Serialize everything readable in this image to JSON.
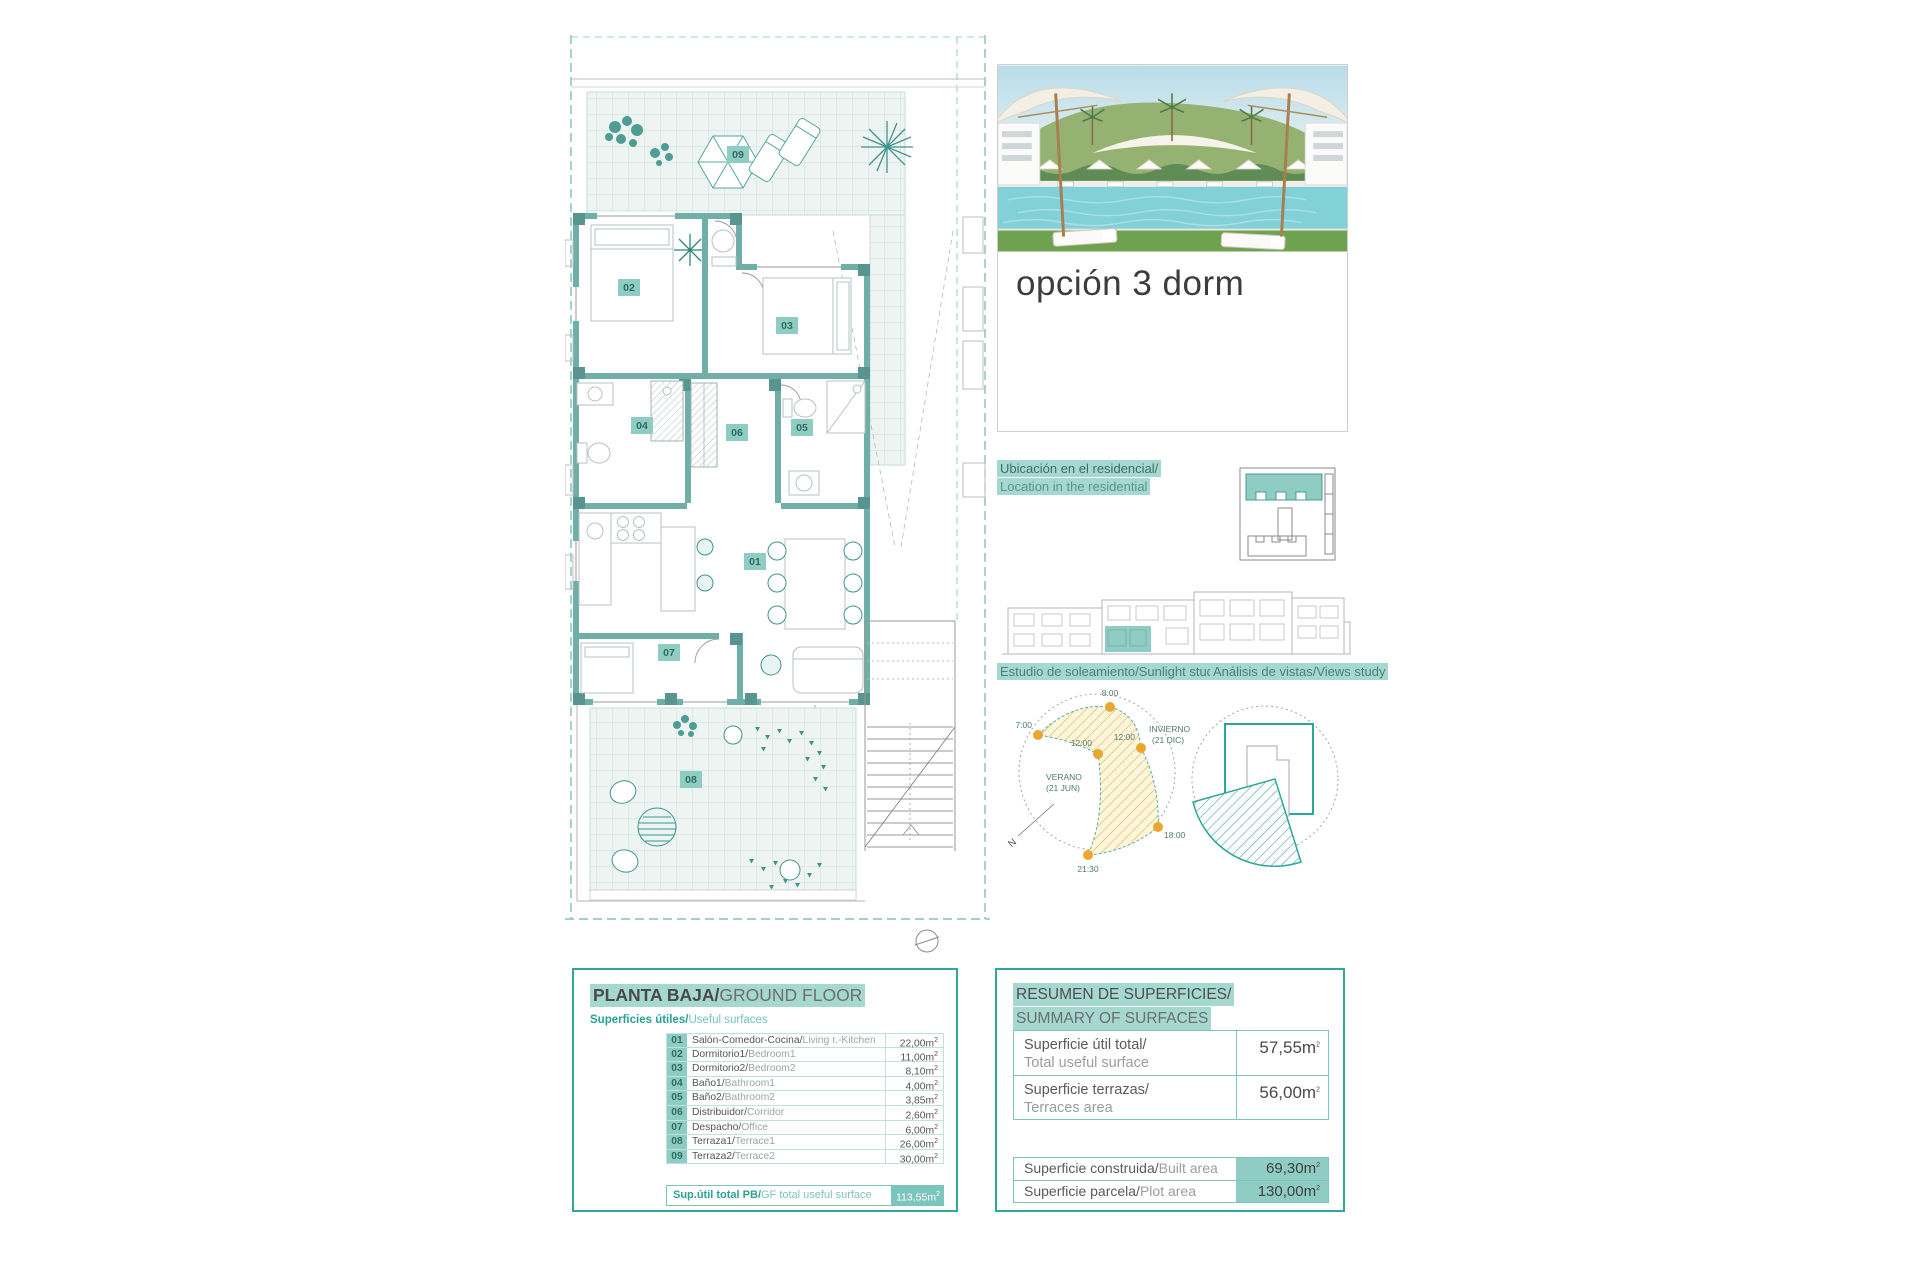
{
  "photo_card": {
    "title": "opción 3 dorm"
  },
  "location": {
    "line1": "Ubicación en el residencial/",
    "line2": "Location in the residential"
  },
  "sunlight": {
    "label": "Estudio de soleamiento/Sunlight study",
    "t7": "7:00",
    "t8": "8:00",
    "t12_summer": "12:00",
    "t12_winter": "12:00",
    "t18": "18:00",
    "t2130": "21:30",
    "winter_l1": "INVIERNO",
    "winter_l2": "(21 DIC)",
    "summer_l1": "VERANO",
    "summer_l2": "(21 JUN)",
    "north": "N"
  },
  "views": {
    "label": "Análisis de vistas/Views study"
  },
  "ground_floor": {
    "title_es": "PLANTA BAJA/",
    "title_en": "GROUND FLOOR",
    "subtitle_es": "Superficies útiles/",
    "subtitle_en": "Useful surfaces",
    "rooms": [
      {
        "code": "01",
        "es": "Salón-Comedor-Cocina/",
        "en": "Living r.-Kitchen",
        "area": "22,00"
      },
      {
        "code": "02",
        "es": "Dormitorio1/",
        "en": "Bedroom1",
        "area": "11,00"
      },
      {
        "code": "03",
        "es": "Dormitorio2/",
        "en": "Bedroom2",
        "area": "8,10"
      },
      {
        "code": "04",
        "es": "Baño1/",
        "en": "Bathroom1",
        "area": "4,00"
      },
      {
        "code": "05",
        "es": "Baño2/",
        "en": "Bathroom2",
        "area": "3,85"
      },
      {
        "code": "06",
        "es": "Distribuidor/",
        "en": "Corridor",
        "area": "2,60"
      },
      {
        "code": "07",
        "es": "Despacho/",
        "en": "Office",
        "area": "6,00"
      },
      {
        "code": "08",
        "es": "Terraza1/",
        "en": "Terrace1",
        "area": "26,00"
      },
      {
        "code": "09",
        "es": "Terraza2/",
        "en": "Terrace2",
        "area": "30,00"
      }
    ],
    "total_es": "Sup.útil total PB/",
    "total_en": "GF total useful surface",
    "total_area": "113,55"
  },
  "summary": {
    "title_line1": "RESUMEN DE SUPERFICIES/",
    "title_line2": "SUMMARY OF SURFACES",
    "rows_top": [
      {
        "es": "Superficie útil total/",
        "en": "Total useful surface",
        "value": "57,55"
      },
      {
        "es": "Superficie terrazas/",
        "en": "Terraces area",
        "value": "56,00"
      }
    ],
    "rows_bottom": [
      {
        "es": "Superficie construida/",
        "en": "Built area",
        "value": "69,30"
      },
      {
        "es": "Superficie parcela/",
        "en": "Plot area",
        "value": "130,00"
      }
    ]
  },
  "units": {
    "m": "m",
    "sup": "2"
  },
  "colors": {
    "teal": "#2fa79a",
    "teal_light": "#8fccc3",
    "highlight": "#a5d8d0",
    "wall": "#6fafa8",
    "orange": "#eca62f"
  }
}
